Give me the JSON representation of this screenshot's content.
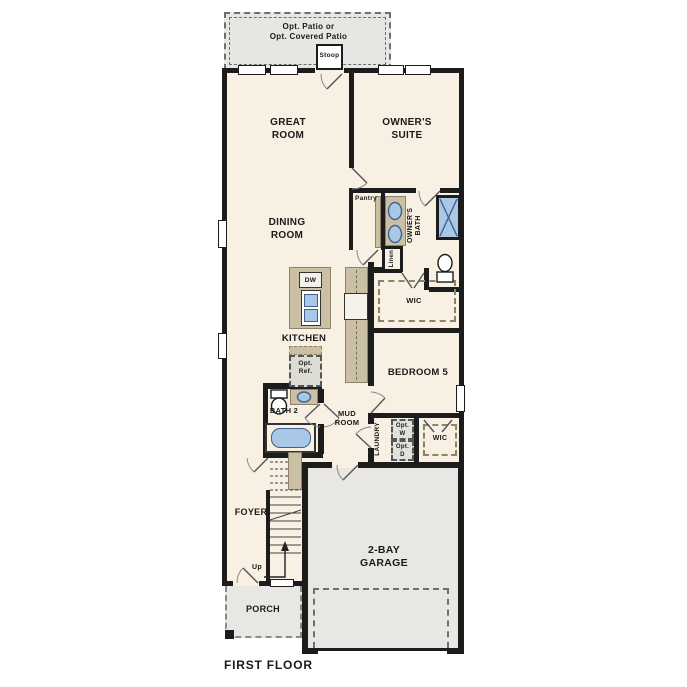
{
  "title": "FIRST FLOOR",
  "outdoor": {
    "patio": "Opt. Patio or\nOpt. Covered Patio",
    "stoop": "Stoop",
    "porch": "PORCH"
  },
  "rooms": {
    "great_room": "GREAT\nROOM",
    "owners_suite": "OWNER'S\nSUITE",
    "dining_room": "DINING\nROOM",
    "pantry": "Pantry",
    "owners_bath": "OWNER'S\nBATH",
    "linen": "Linen",
    "owners_wic": "WIC",
    "kitchen": "KITCHEN",
    "bath_2": "BATH 2",
    "mud_room": "MUD\nROOM",
    "bedroom_5": "BEDROOM 5",
    "laundry": "LAUNDRY",
    "wic_2": "WIC",
    "foyer": "FOYER",
    "garage": "2-BAY\nGARAGE"
  },
  "fixtures": {
    "dishwasher": "DW",
    "opt_ref": "Opt.\nRef.",
    "opt_washer": "Opt.\nW",
    "opt_dryer": "Opt.\nD",
    "up": "Up"
  },
  "colors": {
    "wall": "#1c1c1c",
    "floor": "#f8f0e2",
    "outdoor": "#e7e6e2",
    "cabinetry": "#cbbfa4",
    "fixture_blue": "#a9c7e7"
  }
}
